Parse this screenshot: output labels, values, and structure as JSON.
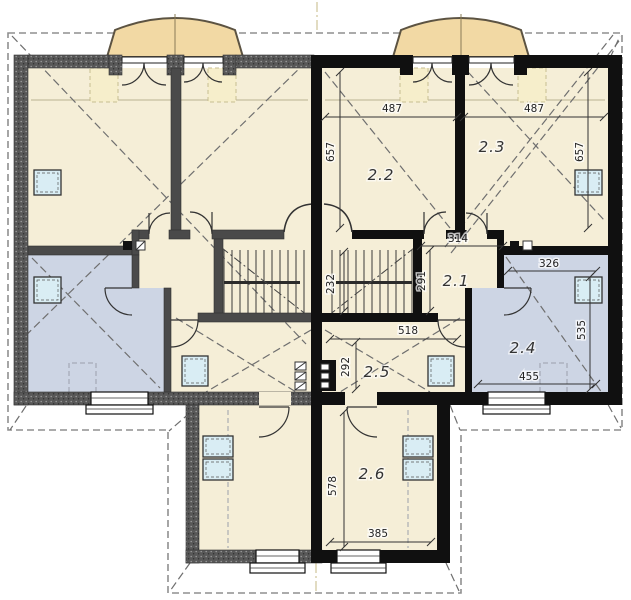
{
  "plan": {
    "rooms": {
      "r21": "2.1",
      "r22": "2.2",
      "r23": "2.3",
      "r24": "2.4",
      "r25": "2.5",
      "r26": "2.6"
    },
    "dims": {
      "room22_width": "487",
      "room23_width": "487",
      "room22_depth": "657",
      "room23_depth": "657",
      "hall_width": "314",
      "hall_depth": "291",
      "stair_run": "232",
      "room24_top_width": "326",
      "room24_depth": "535",
      "room24_bottom_width": "455",
      "room25_width": "518",
      "room25_depth": "292",
      "room26_depth": "578",
      "room26_width": "385"
    },
    "colors": {
      "active_wall": "#101010",
      "inactive_wall": "#585858",
      "room_cream": "#f5eed7",
      "room_blue": "#cdd5e4",
      "dormer_tan": "#f2d9a4",
      "skylight_blue": "#d9edf4"
    }
  }
}
